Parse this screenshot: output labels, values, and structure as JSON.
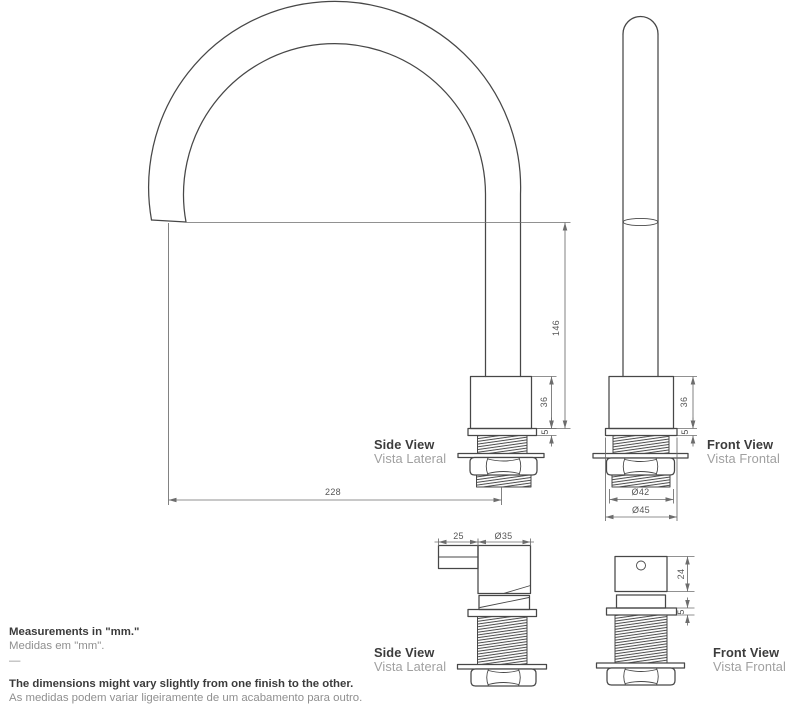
{
  "views": {
    "spout_side": {
      "title": "Side View",
      "subtitle": "Vista Lateral"
    },
    "spout_front": {
      "title": "Front View",
      "subtitle": "Vista Frontal"
    },
    "handle_side": {
      "title": "Side View",
      "subtitle": "Vista Lateral"
    },
    "handle_front": {
      "title": "Front View",
      "subtitle": "Vista Frontal"
    }
  },
  "dimensions": {
    "spout_outlet_height": "146",
    "spout_reach": "228",
    "spout_side_body_height": "36",
    "spout_side_flange": "5",
    "spout_front_body_height": "36",
    "spout_front_flange": "5",
    "thread_diameter": "Ø42",
    "flange_diameter": "Ø45",
    "handle_lever_depth": "25",
    "handle_diameter": "Ø35",
    "handle_body_height": "24",
    "handle_flange": "5"
  },
  "notes": {
    "units_en": "Measurements in \"mm.\"",
    "units_pt": "Medidas em \"mm\".",
    "divider": "—",
    "variance_en": "The dimensions might vary slightly from one finish to the other.",
    "variance_pt": "As medidas podem variar ligeiramente de um acabamento para outro."
  },
  "colors": {
    "line": "#474747",
    "dimension_line": "#6d6d6d",
    "text_dark": "#3b3b3b",
    "text_muted": "#8f8f8f",
    "background": "#ffffff"
  }
}
